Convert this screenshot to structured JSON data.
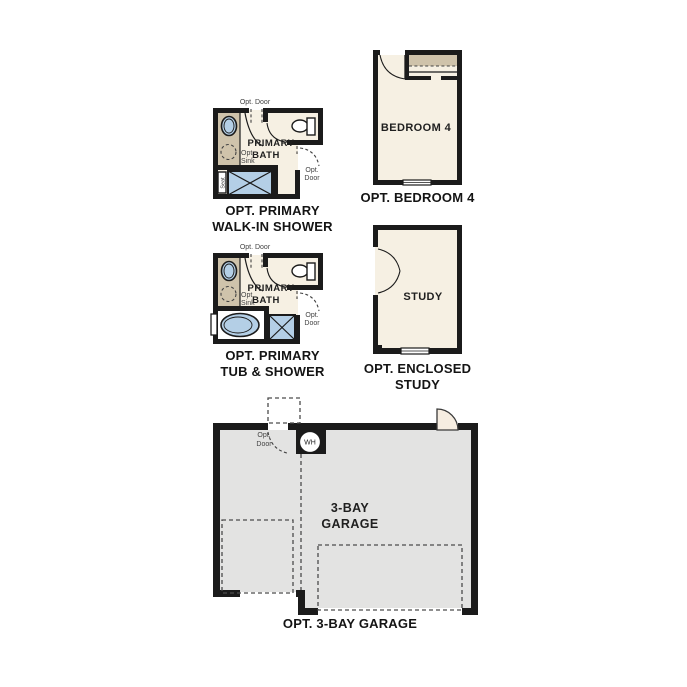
{
  "title": "Floor plan options",
  "colors": {
    "wall": "#1b1b1b",
    "room_fill": "#f6f0e3",
    "counter": "#cfc3ab",
    "fixture_blue": "#b4cfe6",
    "garage_fill": "#e3e3e2",
    "door_fill": "#f6ede1",
    "label": "#434343"
  },
  "plans": {
    "walkin_shower": {
      "caption": "OPT. PRIMARY\nWALK-IN SHOWER",
      "room_label": [
        "PRIMARY",
        "BATH"
      ],
      "opt_door_top": "Opt. Door",
      "opt_door_side": [
        "Opt.",
        "Door"
      ],
      "opt_sink": [
        "Opt.",
        "Sink"
      ],
      "seat": "Seat"
    },
    "tub_shower": {
      "caption": "OPT. PRIMARY\nTUB & SHOWER",
      "room_label": [
        "PRIMARY",
        "BATH"
      ],
      "opt_door_top": "Opt. Door",
      "opt_door_side": [
        "Opt.",
        "Door"
      ],
      "opt_sink": [
        "Opt.",
        "Sink"
      ]
    },
    "bedroom4": {
      "caption": "OPT. BEDROOM 4",
      "room_label": "BEDROOM 4"
    },
    "study": {
      "caption": "OPT. ENCLOSED\nSTUDY",
      "room_label": "STUDY"
    },
    "garage": {
      "caption": "OPT. 3-BAY GARAGE",
      "room_label": [
        "3-BAY",
        "GARAGE"
      ],
      "water_heater": "WH",
      "opt_door": [
        "Opt.",
        "Door"
      ]
    }
  }
}
